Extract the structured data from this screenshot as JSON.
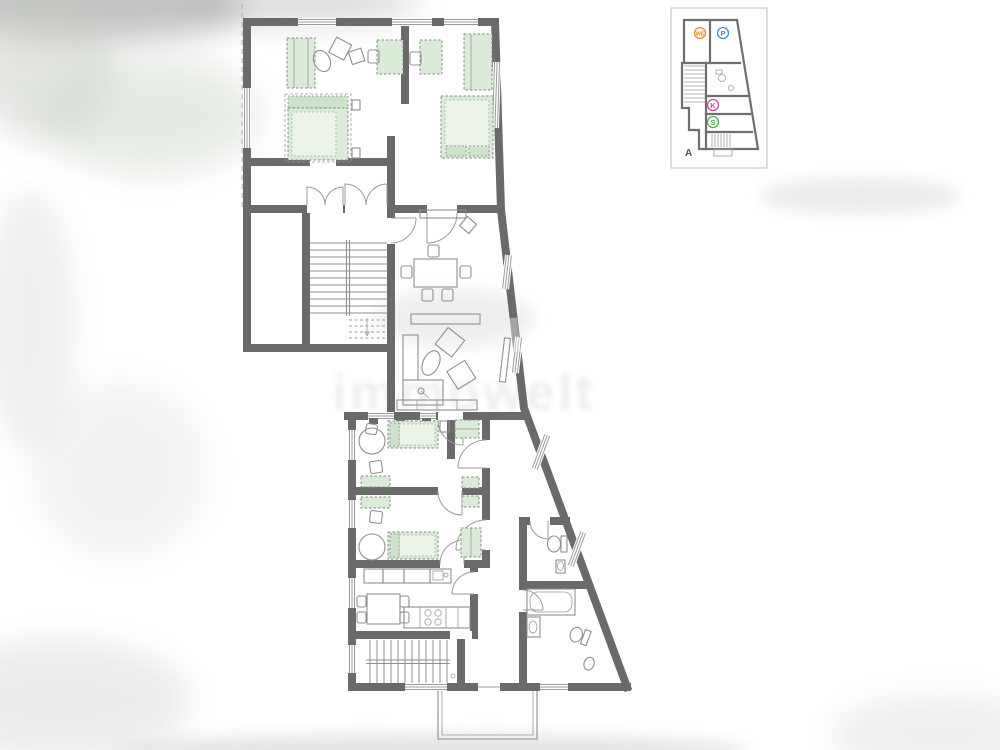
{
  "palette": {
    "wall": "#6a6a6a",
    "thin_line": "#8f8f8f",
    "furniture_fill": "#dcead9",
    "furniture_inner": "#ecf4e8",
    "furniture_band": "#cfe2cc",
    "furniture_stroke": "#7d937d",
    "inset_border": "#c8c8c8",
    "background": "#ffffff",
    "watermark_color": "#9aa09a"
  },
  "watermark": {
    "text": "immowelt"
  },
  "inset": {
    "label": "A",
    "badges": [
      {
        "id": "unit",
        "label": "WE",
        "color": "#e5912f",
        "fill": "#fdf2e0"
      },
      {
        "id": "parking",
        "label": "P",
        "color": "#4a90d2",
        "fill": "#ffffff"
      },
      {
        "id": "cellar",
        "label": "K",
        "color": "#c04f9e",
        "fill": "#ffffff"
      },
      {
        "id": "storage",
        "label": "S",
        "color": "#4fae52",
        "fill": "#ffffff"
      }
    ]
  }
}
